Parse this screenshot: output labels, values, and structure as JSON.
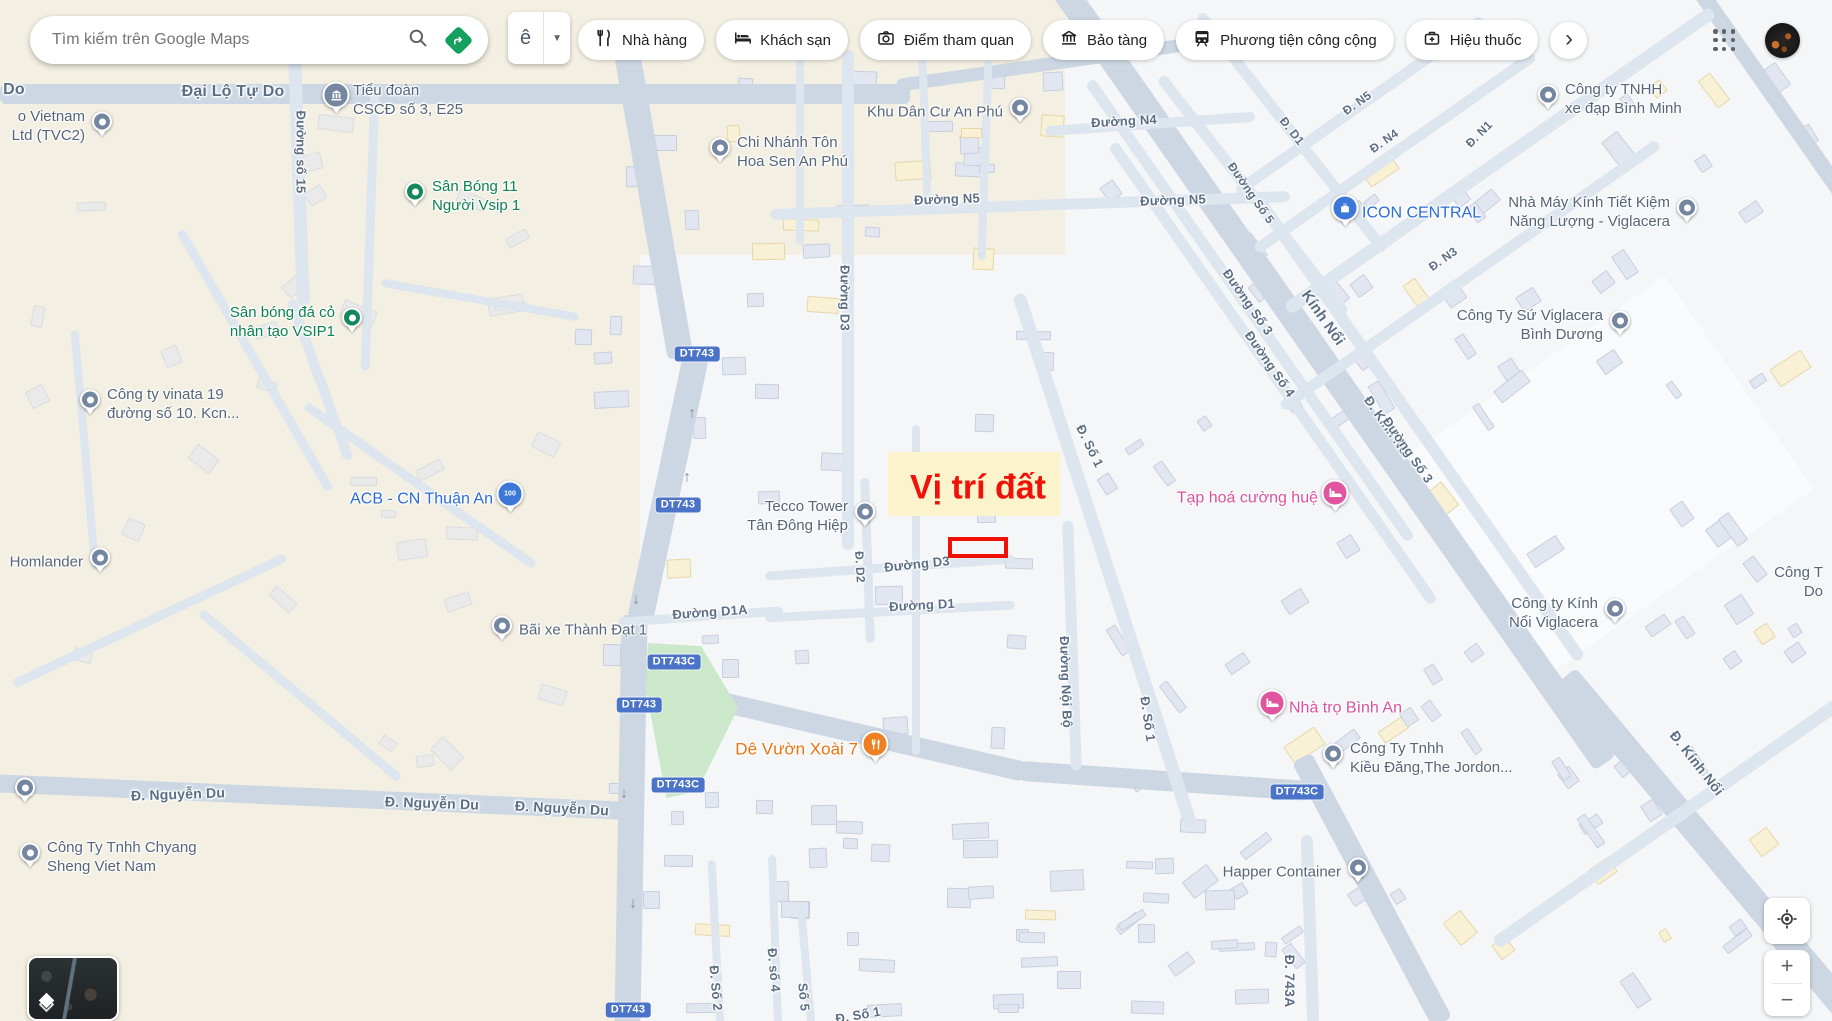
{
  "topbar": {
    "search": {
      "placeholder": "Tìm kiếm trên Google Maps"
    },
    "keyboard_key": "ê",
    "chips": [
      {
        "label": "Nhà hàng",
        "icon": "restaurant-icon"
      },
      {
        "label": "Khách sạn",
        "icon": "hotel-icon"
      },
      {
        "label": "Điểm tham quan",
        "icon": "attractions-icon"
      },
      {
        "label": "Bảo tàng",
        "icon": "museum-icon"
      },
      {
        "label": "Phương tiện công cộng",
        "icon": "transit-icon"
      },
      {
        "label": "Hiệu thuốc",
        "icon": "pharmacy-icon"
      }
    ],
    "more_label": "›"
  },
  "map": {
    "annotation": {
      "label": "Vị trí đất",
      "color": "#ef1208"
    },
    "shields": [
      {
        "t": "DT743",
        "x": 697,
        "y": 354
      },
      {
        "t": "DT743",
        "x": 678,
        "y": 505
      },
      {
        "t": "DT743C",
        "x": 674,
        "y": 662
      },
      {
        "t": "DT743",
        "x": 639,
        "y": 705
      },
      {
        "t": "DT743C",
        "x": 678,
        "y": 785
      },
      {
        "t": "DT743C",
        "x": 1297,
        "y": 792
      },
      {
        "t": "DT743",
        "x": 628,
        "y": 1010
      }
    ],
    "road_labels": [
      {
        "t": "Đại Lộ Tự Do",
        "x": 233,
        "y": 92,
        "r": 0,
        "s": 16
      },
      {
        "t": "Do",
        "x": 14,
        "y": 90,
        "r": 0,
        "s": 16
      },
      {
        "t": "Đường số 15",
        "x": 301,
        "y": 152,
        "r": 90,
        "s": 13
      },
      {
        "t": "Đường N5",
        "x": 947,
        "y": 199,
        "r": -2,
        "s": 13
      },
      {
        "t": "Đường N5",
        "x": 1173,
        "y": 200,
        "r": -2,
        "s": 13
      },
      {
        "t": "Đường N4",
        "x": 1124,
        "y": 121,
        "r": -3,
        "s": 13
      },
      {
        "t": "Đường D3",
        "x": 845,
        "y": 298,
        "r": 90,
        "s": 13
      },
      {
        "t": "Đường D3",
        "x": 917,
        "y": 564,
        "r": -6,
        "s": 13
      },
      {
        "t": "Đường D1",
        "x": 922,
        "y": 605,
        "r": -3,
        "s": 13
      },
      {
        "t": "Đường D1A",
        "x": 710,
        "y": 612,
        "r": -4,
        "s": 13
      },
      {
        "t": "Đ. D2",
        "x": 860,
        "y": 567,
        "r": 87,
        "s": 12
      },
      {
        "t": "Đường Nội Bộ",
        "x": 1066,
        "y": 682,
        "r": 88,
        "s": 13
      },
      {
        "t": "Đ. Số 1",
        "x": 1090,
        "y": 446,
        "r": 64,
        "s": 13
      },
      {
        "t": "Đ. Số 1",
        "x": 1148,
        "y": 719,
        "r": 82,
        "s": 13
      },
      {
        "t": "Đ. Nguyễn Du",
        "x": 178,
        "y": 794,
        "r": -2,
        "s": 14
      },
      {
        "t": "Đ. Nguyễn Du",
        "x": 432,
        "y": 803,
        "r": 2,
        "s": 14
      },
      {
        "t": "Đ. Nguyễn Du",
        "x": 562,
        "y": 808,
        "r": 3,
        "s": 14
      },
      {
        "t": "Đ. Số 2",
        "x": 716,
        "y": 988,
        "r": 85,
        "s": 13
      },
      {
        "t": "Đ. số 4",
        "x": 774,
        "y": 970,
        "r": 85,
        "s": 13
      },
      {
        "t": "Số 5",
        "x": 804,
        "y": 997,
        "r": 85,
        "s": 13
      },
      {
        "t": "Đ. Số 1",
        "x": 858,
        "y": 1015,
        "r": -10,
        "s": 13
      },
      {
        "t": "Đ. 743A",
        "x": 1290,
        "y": 981,
        "r": 90,
        "s": 14
      },
      {
        "t": "Đ. Kính Nổi",
        "x": 1697,
        "y": 763,
        "r": 52,
        "s": 14
      },
      {
        "t": "Kính Nổi",
        "x": 1323,
        "y": 318,
        "r": 55,
        "s": 15
      },
      {
        "t": "Đ. Kính Nổi",
        "x": 1388,
        "y": 427,
        "r": 55,
        "s": 13
      },
      {
        "t": "Đường Số 3",
        "x": 1248,
        "y": 302,
        "r": 55,
        "s": 13
      },
      {
        "t": "Đường Số 4",
        "x": 1270,
        "y": 364,
        "r": 55,
        "s": 13
      },
      {
        "t": "Đường Số 3",
        "x": 1408,
        "y": 450,
        "r": 55,
        "s": 13
      },
      {
        "t": "Đ. N5",
        "x": 1357,
        "y": 103,
        "r": -35,
        "s": 12
      },
      {
        "t": "Đ. N4",
        "x": 1384,
        "y": 141,
        "r": -35,
        "s": 12
      },
      {
        "t": "Đ. N1",
        "x": 1479,
        "y": 134,
        "r": -45,
        "s": 12
      },
      {
        "t": "Đ. N3",
        "x": 1443,
        "y": 259,
        "r": -35,
        "s": 12
      },
      {
        "t": "Đ. D1",
        "x": 1292,
        "y": 131,
        "r": 52,
        "s": 12
      },
      {
        "t": "Đường Số 5",
        "x": 1251,
        "y": 193,
        "r": 55,
        "s": 12
      }
    ],
    "pois": [
      {
        "id": "tvc2",
        "lines": [
          "o Vietnam",
          "Ltd (TVC2)"
        ],
        "x": 102,
        "y": 126,
        "pin": "gray",
        "glyph": "dot",
        "side": "left"
      },
      {
        "id": "tieu-doan-cscd",
        "lines": [
          "Tiểu đoàn",
          "CSCĐ số 3, E25"
        ],
        "x": 336,
        "y": 100,
        "pin": "gray",
        "glyph": "bank",
        "side": "right"
      },
      {
        "id": "san-bong-11-nguoi-vsip1",
        "lines": [
          "Sân Bóng 11",
          "Người Vsip 1"
        ],
        "x": 415,
        "y": 196,
        "pin": "green",
        "glyph": "dot",
        "side": "right"
      },
      {
        "id": "san-bong-da-co-vsip1",
        "lines": [
          "Sân bóng đá cỏ",
          "nhân tạo VSIP1"
        ],
        "x": 352,
        "y": 322,
        "pin": "green",
        "glyph": "dot",
        "side": "left"
      },
      {
        "id": "cong-ty-vinata-19",
        "lines": [
          "Công ty vinata 19",
          "đường số 10. Kcn..."
        ],
        "x": 90,
        "y": 404,
        "pin": "gray",
        "glyph": "dot",
        "side": "right"
      },
      {
        "id": "homlander",
        "lines": [
          "Homlander"
        ],
        "x": 100,
        "y": 562,
        "pin": "gray",
        "glyph": "dot",
        "side": "left"
      },
      {
        "id": "acb-cn-thuan-an",
        "lines": [
          "ACB - CN Thuận An"
        ],
        "x": 510,
        "y": 499,
        "pin": "blue",
        "glyph": "money",
        "side": "left",
        "fs": 16
      },
      {
        "id": "tecco-tower-tan-dong-hiep",
        "lines": [
          "Tecco Tower",
          "Tân Đông Hiệp"
        ],
        "x": 865,
        "y": 516,
        "pin": "gray",
        "glyph": "dot",
        "side": "left"
      },
      {
        "id": "bai-xe-thanh-dat-1",
        "lines": [
          "Bãi xe Thành Đạt 1"
        ],
        "x": 502,
        "y": 630,
        "pin": "gray",
        "glyph": "dot",
        "side": "right"
      },
      {
        "id": "chi-nhanh-ton-hoa-sen",
        "lines": [
          "Chi Nhánh Tôn",
          "Hoa Sen An Phú"
        ],
        "x": 720,
        "y": 152,
        "pin": "gray",
        "glyph": "dot",
        "side": "right"
      },
      {
        "id": "khu-dan-cu-an-phu",
        "lines": [
          "Khu Dân Cư An Phú"
        ],
        "x": 1020,
        "y": 112,
        "pin": "gray",
        "glyph": "dot",
        "side": "left"
      },
      {
        "id": "icon-central",
        "lines": [
          "ICON CENTRAL"
        ],
        "x": 1345,
        "y": 213,
        "pin": "blue",
        "glyph": "bag",
        "side": "right",
        "fs": 16
      },
      {
        "id": "xe-dap-binh-minh",
        "lines": [
          "Công ty TNHH",
          "xe đạp Bình Minh"
        ],
        "x": 1548,
        "y": 99,
        "pin": "gray",
        "glyph": "dot",
        "side": "right"
      },
      {
        "id": "nha-may-kinh-viglacera",
        "lines": [
          "Nhà Máy Kính Tiết Kiệm",
          "Năng Lượng - Viglacera"
        ],
        "x": 1687,
        "y": 212,
        "pin": "gray",
        "glyph": "dot",
        "side": "left"
      },
      {
        "id": "cong-ty-su-viglacera",
        "lines": [
          "Công Ty Sứ Viglacera",
          "Bình Dương"
        ],
        "x": 1620,
        "y": 325,
        "pin": "gray",
        "glyph": "dot",
        "side": "left"
      },
      {
        "id": "tap-hoa-cuong-hue",
        "lines": [
          "Tạp hoá cường huệ"
        ],
        "x": 1335,
        "y": 498,
        "pin": "pink",
        "glyph": "bed",
        "side": "left",
        "fs": 16
      },
      {
        "id": "cong-ty-kinh-noi-viglacera",
        "lines": [
          "Công ty Kính",
          "Nổi Viglacera"
        ],
        "x": 1615,
        "y": 613,
        "pin": "gray",
        "glyph": "dot",
        "side": "left"
      },
      {
        "id": "cong-t-cutoff",
        "lines": [
          "Công T",
          "Do"
        ],
        "x": 1840,
        "y": 582,
        "pin": "none",
        "glyph": "dot",
        "side": "left"
      },
      {
        "id": "nha-tro-binh-an",
        "lines": [
          "Nhà trọ Bình An"
        ],
        "x": 1272,
        "y": 708,
        "pin": "pink",
        "glyph": "bed",
        "side": "right",
        "fs": 16
      },
      {
        "id": "kieu-dang-the-jordon",
        "lines": [
          "Công Ty Tnhh",
          "Kiều Đăng,The Jordon..."
        ],
        "x": 1333,
        "y": 758,
        "pin": "gray",
        "glyph": "dot",
        "side": "right"
      },
      {
        "id": "de-vuon-xoai-7",
        "lines": [
          "Dê Vườn Xoài 7"
        ],
        "x": 875,
        "y": 749,
        "pin": "orange",
        "glyph": "fork",
        "side": "left",
        "fs": 17
      },
      {
        "id": "happer-container",
        "lines": [
          "Happer Container"
        ],
        "x": 1358,
        "y": 872,
        "pin": "gray",
        "glyph": "dot",
        "side": "left"
      },
      {
        "id": "chyang-sheng-viet-nam",
        "lines": [
          "Công Ty Tnhh Chyang",
          "Sheng Viet Nam"
        ],
        "x": 30,
        "y": 857,
        "pin": "gray",
        "glyph": "dot",
        "side": "right"
      },
      {
        "id": "pin-nguyen-du",
        "lines": [],
        "x": 25,
        "y": 792,
        "pin": "gray",
        "glyph": "dot",
        "side": "right"
      }
    ]
  },
  "controls": {
    "zoom_in": "+",
    "zoom_out": "−"
  }
}
